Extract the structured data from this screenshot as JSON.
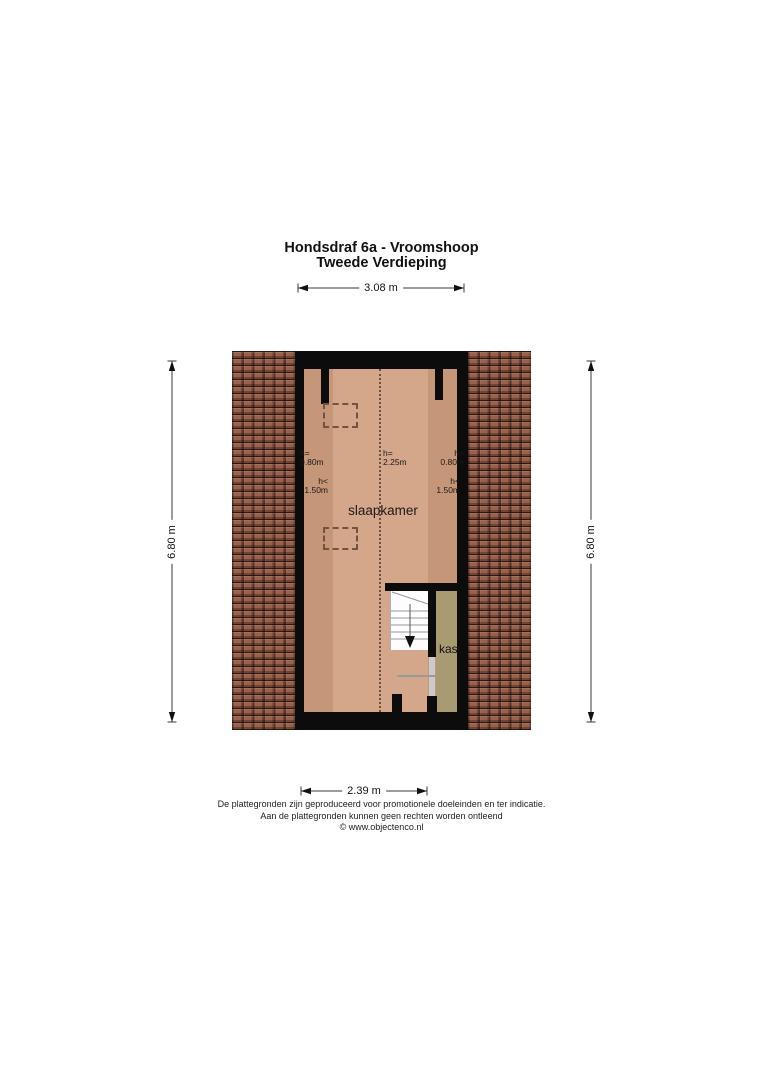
{
  "title": {
    "line1": "Hondsdraf 6a - Vroomshoop",
    "line2": "Tweede Verdieping"
  },
  "dimensions": {
    "top": "3.08 m",
    "left": "6.80 m",
    "right": "6.80 m",
    "bottom": "2.39 m"
  },
  "floorplan": {
    "room_label": "slaapkamer",
    "closet_label": "kast",
    "height_labels": {
      "left_low": {
        "line1": "h=",
        "line2": "0.80m"
      },
      "left_mid": {
        "line1": "h<",
        "line2": "1.50m"
      },
      "center": {
        "line1": "h=",
        "line2": "2.25m"
      },
      "right_low": {
        "line1": "h=",
        "line2": "0.80m"
      },
      "right_mid": {
        "line1": "h<",
        "line2": "1.50m"
      }
    },
    "colors": {
      "roof_tile": "#99604a",
      "wall": "#0c0c0c",
      "floor_main": "#d5a78a",
      "floor_low_band": "#c69678",
      "closet": "#a89b72",
      "stair": "#fdfdfd",
      "door": "#cbcbcb"
    }
  },
  "footer": {
    "line1": "De plattegronden zijn geproduceerd voor promotionele doeleinden en ter indicatie.",
    "line2": "Aan de plattegronden kunnen geen rechten worden ontleend",
    "line3": "© www.objectenco.nl"
  }
}
